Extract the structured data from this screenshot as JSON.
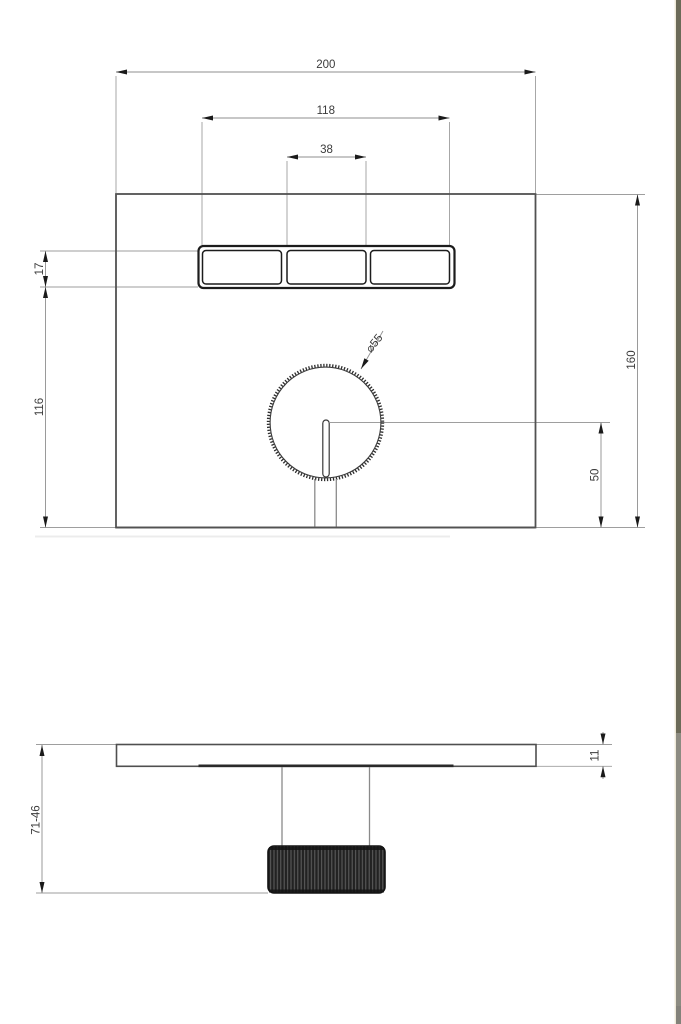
{
  "page": {
    "background_color": "#ffffff",
    "right_edge_bar": {
      "divider_color": "#efe9d8",
      "top_color": "#6b6a58",
      "lower_color": "#8c8b81"
    }
  },
  "drawing": {
    "style": {
      "dimension_line_color": "#8f8f8f",
      "outline_color": "#525252",
      "dark_detail_color": "#1c1c1c",
      "text_color": "#3b3b3b"
    },
    "front_view": {
      "dim_plate_width": "200",
      "dim_buttons_span": "118",
      "dim_button_width": "38",
      "dim_button_height": "17",
      "dim_buttons_to_plate_bottom": "116",
      "dim_plate_height": "160",
      "dim_knob_center_to_plate_bottom": "50",
      "dim_knob_diameter": "⌀55"
    },
    "side_view": {
      "dim_plate_thickness": "11",
      "dim_installation_depth_range": "71-46"
    }
  }
}
